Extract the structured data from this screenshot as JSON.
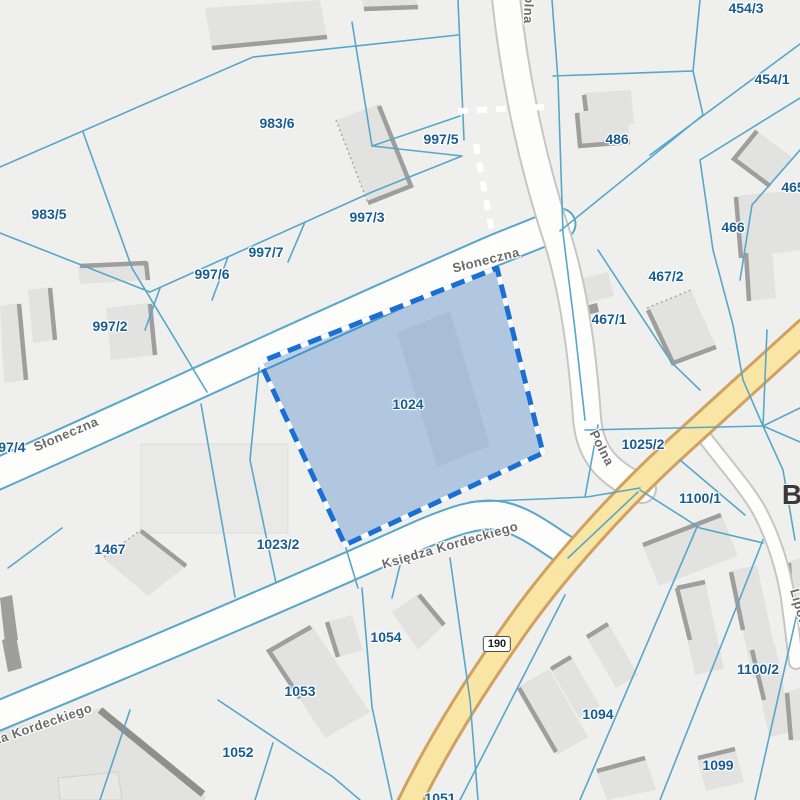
{
  "map": {
    "highlighted_parcel": "1024",
    "colors": {
      "bg": "#efefee",
      "pline": "#57a7c9",
      "ptext": "#175d92",
      "stext": "#6b6b6b",
      "hl": "#2f74c4",
      "hlborder": "#1a6fd4",
      "yfill": "#f9e6a5",
      "yedge": "#d2a061",
      "bldg": "#e2e2e0",
      "bshadow": "#9e9e9c"
    },
    "road_badge": {
      "text": "190",
      "x": 497,
      "y": 644
    },
    "place_label": {
      "text": "B",
      "x": 792,
      "y": 495
    },
    "parcel_labels": [
      {
        "text": "983/5",
        "x": 49,
        "y": 214
      },
      {
        "text": "983/6",
        "x": 277,
        "y": 123
      },
      {
        "text": "997/5",
        "x": 441,
        "y": 139
      },
      {
        "text": "997/3",
        "x": 367,
        "y": 217
      },
      {
        "text": "997/7",
        "x": 266,
        "y": 252
      },
      {
        "text": "997/6",
        "x": 212,
        "y": 274
      },
      {
        "text": "997/2",
        "x": 110,
        "y": 326
      },
      {
        "text": "997/4",
        "x": 8,
        "y": 447
      },
      {
        "text": "1024",
        "x": 408,
        "y": 404
      },
      {
        "text": "1467",
        "x": 110,
        "y": 549
      },
      {
        "text": "1023/2",
        "x": 278,
        "y": 544
      },
      {
        "text": "1025/2",
        "x": 643,
        "y": 444
      },
      {
        "text": "486",
        "x": 617,
        "y": 139
      },
      {
        "text": "454/3",
        "x": 746,
        "y": 8
      },
      {
        "text": "454/1",
        "x": 772,
        "y": 79
      },
      {
        "text": "465",
        "x": 793,
        "y": 187
      },
      {
        "text": "466",
        "x": 733,
        "y": 227
      },
      {
        "text": "467/2",
        "x": 666,
        "y": 276
      },
      {
        "text": "467/1",
        "x": 609,
        "y": 319
      },
      {
        "text": "1100/1",
        "x": 700,
        "y": 498
      },
      {
        "text": "1100/2",
        "x": 758,
        "y": 669
      },
      {
        "text": "1094",
        "x": 598,
        "y": 714
      },
      {
        "text": "1099",
        "x": 718,
        "y": 765
      },
      {
        "text": "1054",
        "x": 386,
        "y": 637
      },
      {
        "text": "1053",
        "x": 300,
        "y": 691
      },
      {
        "text": "1052",
        "x": 238,
        "y": 752
      },
      {
        "text": "1051",
        "x": 440,
        "y": 798
      }
    ],
    "street_labels": [
      {
        "text": "Słoneczna",
        "x": 66,
        "y": 434,
        "rotate": -23
      },
      {
        "text": "Słoneczna",
        "x": 486,
        "y": 260,
        "rotate": -14
      },
      {
        "text": "Polna",
        "x": 529,
        "y": 5,
        "rotate": 92
      },
      {
        "text": "Polna",
        "x": 602,
        "y": 448,
        "rotate": 63
      },
      {
        "text": "Księdza Kordeckiego",
        "x": 450,
        "y": 545,
        "rotate": -16
      },
      {
        "text": "Księdza Kordeckiego",
        "x": 25,
        "y": 730,
        "rotate": -19
      },
      {
        "text": "Lipowa",
        "x": 801,
        "y": 612,
        "rotate": 74
      }
    ]
  }
}
